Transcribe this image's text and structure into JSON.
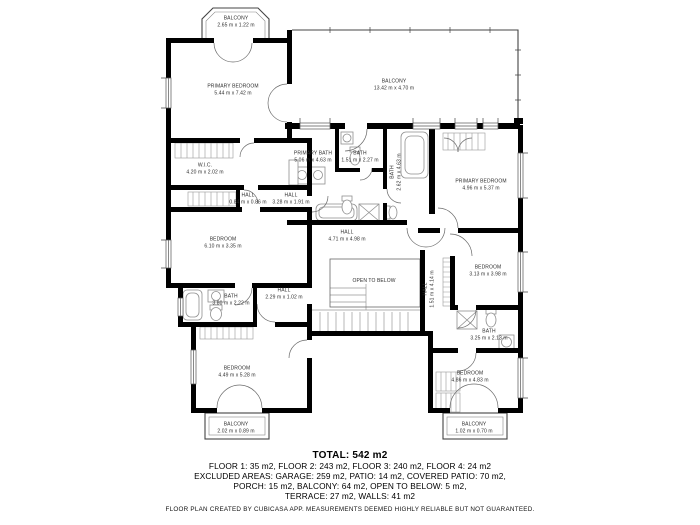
{
  "colors": {
    "wall": "#000000",
    "background": "#ffffff",
    "balcony_line": "#444444",
    "fixture_line": "#8f8f8f",
    "door_arc": "#6b6b6b"
  },
  "rooms": [
    {
      "name": "BALCONY",
      "dims": "2.65 m x 1.22 m"
    },
    {
      "name": "PRIMARY BEDROOM",
      "dims": "5.44 m x 7.42 m"
    },
    {
      "name": "BALCONY",
      "dims": "13.42 m x 4.70 m"
    },
    {
      "name": "PRIMARY BATH",
      "dims": "5.06 m x 4.63 m"
    },
    {
      "name": "BATH",
      "dims": "1.51 m x 2.27 m"
    },
    {
      "name": "BATH",
      "dims": "2.62 m x 4.63 m"
    },
    {
      "name": "PRIMARY BEDROOM",
      "dims": "4.96 m x 5.37 m"
    },
    {
      "name": "W.I.C.",
      "dims": "4.20 m x 2.02 m"
    },
    {
      "name": "HALL",
      "dims": "0.84 m x 0.86 m"
    },
    {
      "name": "HALL",
      "dims": "3.28 m x 1.91 m"
    },
    {
      "name": "BEDROOM",
      "dims": "6.10 m x 3.35 m"
    },
    {
      "name": "HALL",
      "dims": "4.71 m x 4.98 m"
    },
    {
      "name": "OPEN TO BELOW",
      "dims": ""
    },
    {
      "name": "HALL",
      "dims": "1.51 m x 4.14 m"
    },
    {
      "name": "BEDROOM",
      "dims": "3.13 m x 3.98 m"
    },
    {
      "name": "BATH",
      "dims": "3.80 m x 2.22 m"
    },
    {
      "name": "HALL",
      "dims": "2.29 m x 1.02 m"
    },
    {
      "name": "BEDROOM",
      "dims": "4.49 m x 5.28 m"
    },
    {
      "name": "BATH",
      "dims": "3.25 m x 2.13 m"
    },
    {
      "name": "BEDROOM",
      "dims": "4.86 m x 4.83 m"
    },
    {
      "name": "BALCONY",
      "dims": "2.02 m x 0.89 m"
    },
    {
      "name": "BALCONY",
      "dims": "1.02 m x 0.70 m"
    }
  ],
  "footer": {
    "total": "TOTAL: 542 m2",
    "floors": "FLOOR 1: 35 m2, FLOOR 2: 243 m2, FLOOR 3: 240 m2, FLOOR 4: 24 m2",
    "excluded1": "EXCLUDED AREAS: GARAGE: 259 m2, PATIO: 14 m2, COVERED PATIO: 70 m2,",
    "excluded2": "PORCH: 15 m2, BALCONY: 64 m2, OPEN TO BELOW: 5 m2,",
    "excluded3": "TERRACE: 27 m2, WALLS: 41 m2",
    "disclaimer": "FLOOR PLAN CREATED BY CUBICASA APP. MEASUREMENTS DEEMED HIGHLY RELIABLE BUT NOT GUARANTEED."
  }
}
